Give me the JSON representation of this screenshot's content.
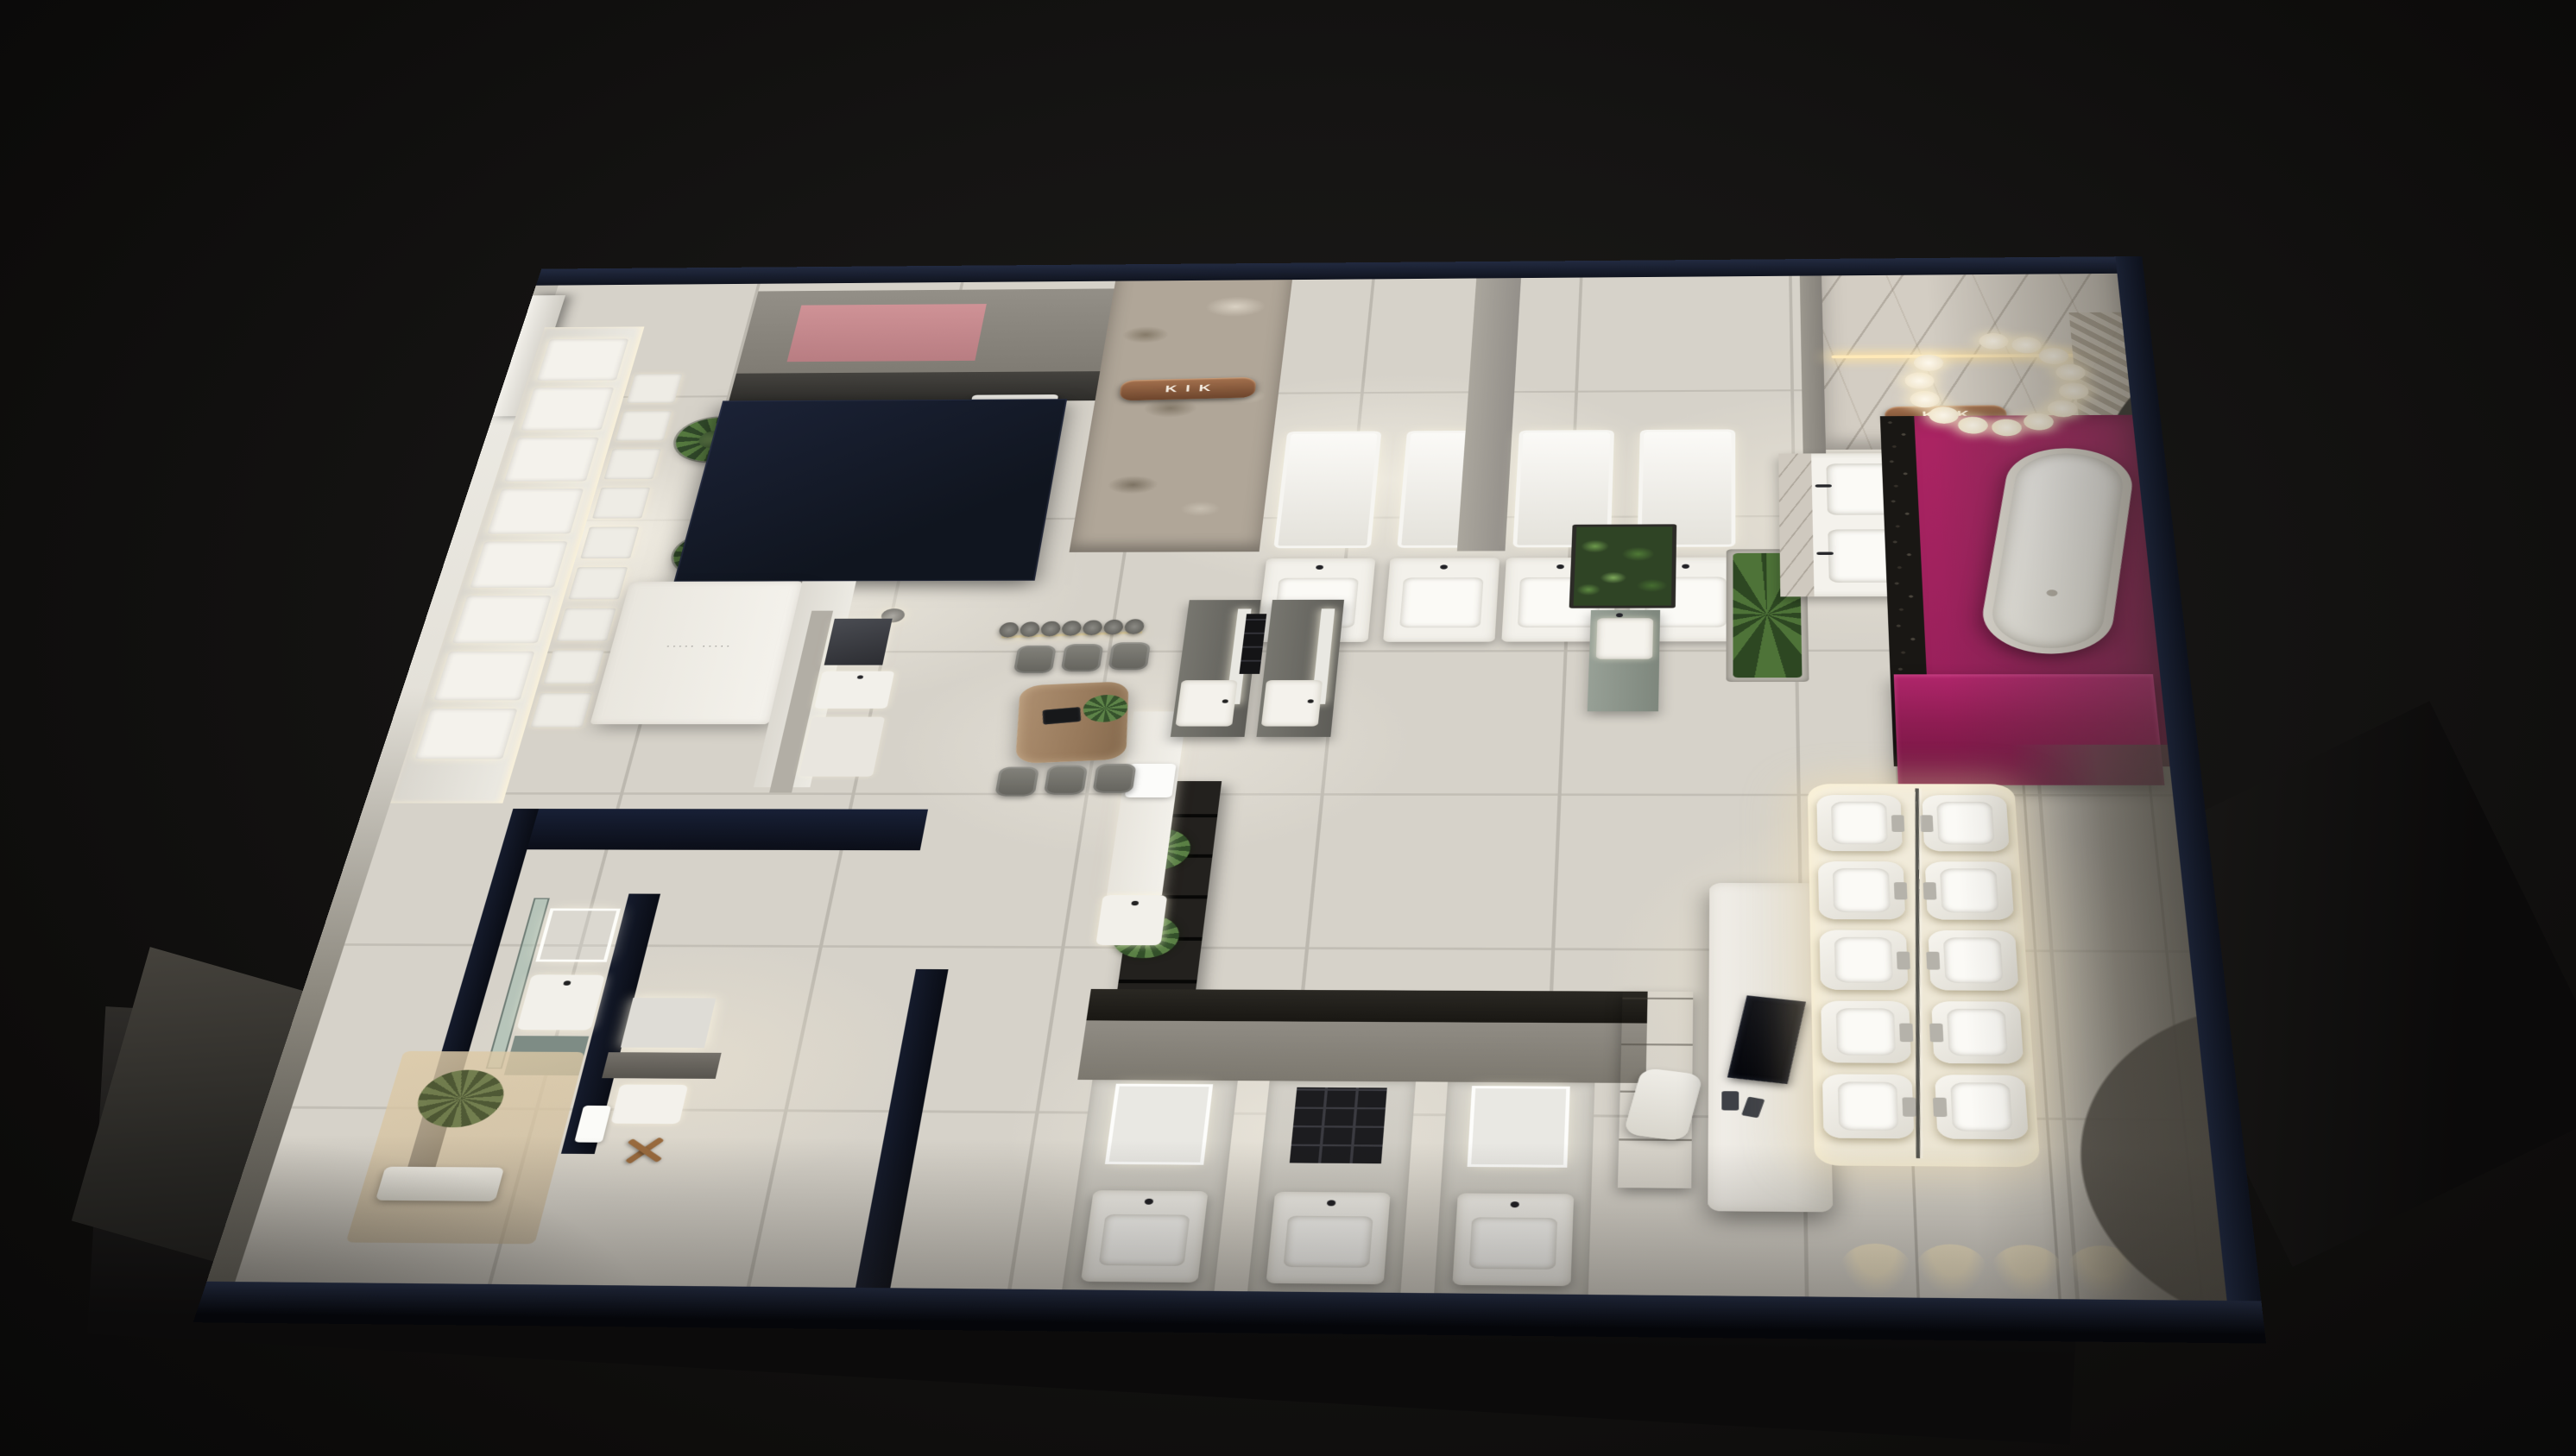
{
  "scene": {
    "description": "Night-time aerial cutaway 3D render of a bathroom and sanitary-ware showroom floor plan",
    "view": "isometric top-down cutaway",
    "background": "dark studio void"
  },
  "signs": {
    "stone_wall": "KIK",
    "marble_wall": "KIK",
    "desk_logo": "····· ·····"
  },
  "palette": {
    "background": "#0e0d0c",
    "wall_top_navy": "#151b2b",
    "floor_tile": "#d6d2c9",
    "magenta_accent": "#a1215c",
    "copper_sign": "#8a5a3b",
    "rose_panel": "#c8898d",
    "plant_green": "#4e6b3a",
    "wood_table": "#a3876a",
    "led_warm": "#ffe9b8"
  },
  "counts": {
    "shower_panels": 8,
    "shower_valves": 9,
    "vanity_pair": 2,
    "bubble_lights": 13,
    "pendant_discs": 7,
    "chairs_per_row": 3,
    "south_alcoves": 3,
    "toilets_per_column": 5,
    "wall_light_pools": 4,
    "shelf_plants": 3
  }
}
